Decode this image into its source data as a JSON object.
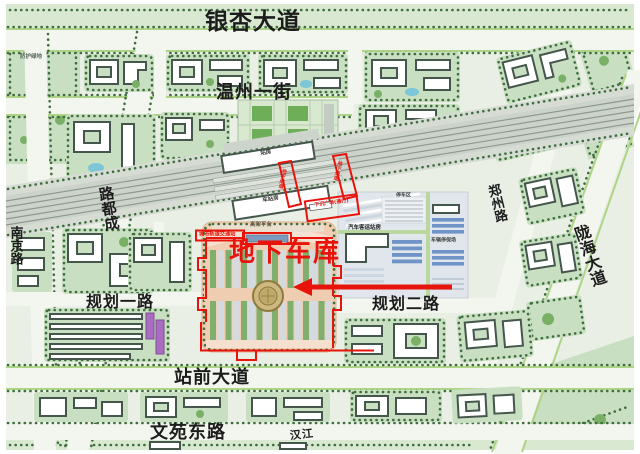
{
  "map": {
    "roads": {
      "yinxing": "银杏大道",
      "wenzhou": "温州一街",
      "nanjing": "南京路",
      "chengdu": "成都路",
      "zhengzhou": "郑州路",
      "longhai": "陇海大道",
      "guihua1": "规划一路",
      "guihua2": "规划二路",
      "zhanqian": "站前大道",
      "wenyuan": "文苑东路",
      "hanjiang": "汉江"
    },
    "annotation": {
      "underground_garage": "地下车库",
      "metro_station": "城市轨道交通站",
      "sunken_plaza": "下沉广场(通行)",
      "corridor_a": "地下通道",
      "corridor_b": "地下通道"
    },
    "facilities": {
      "bus_terminal": "汽车客运站房",
      "station_hall_north": "站房",
      "station_hall_south": "车站房",
      "elevated_deck": "高架平台",
      "parking_zone": "停车区",
      "bus_depot": "车辆停保场",
      "green_buffer": "防护绿地"
    },
    "colors": {
      "annotation_red": "#e8140c",
      "plaza_tan": "#f1cdb2",
      "block_green": "#c9dfc2",
      "road": "#f3f5ef",
      "water_blue": "#7cc6d8",
      "purple_building": "#a96cc1",
      "parking_blue": "#6e94c8"
    }
  }
}
